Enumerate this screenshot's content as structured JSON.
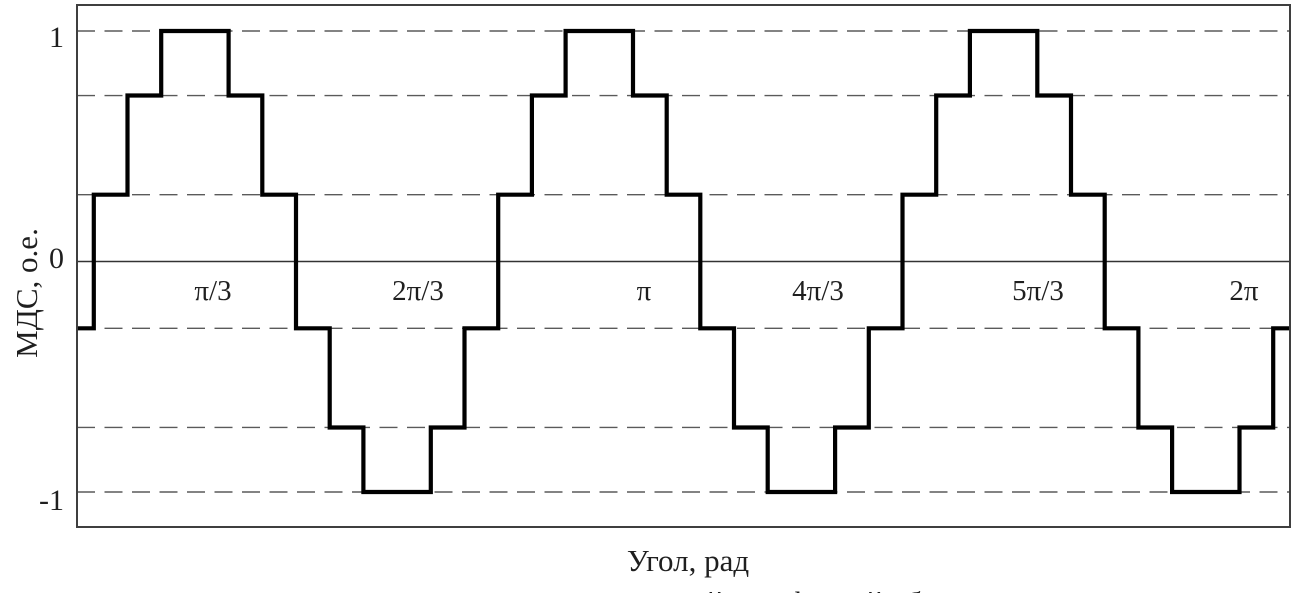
{
  "figure": {
    "caption": "Рис. 6. МДС симметричной трехфазной обмотки"
  },
  "chart_data": {
    "type": "line",
    "subtype": "step-staircase-waveform",
    "title": "",
    "xlabel": "Угол, рад",
    "ylabel": "МДС, о.е.",
    "xlim_rad": [
      0,
      6.2832
    ],
    "ylim": [
      -1.15,
      1.11
    ],
    "grid": "dashed horizontal lines at waveform step levels",
    "legend": "none",
    "x_ticks": [
      {
        "label": "π/3",
        "value_rad": 1.0472
      },
      {
        "label": "2π/3",
        "value_rad": 2.0944
      },
      {
        "label": "π",
        "value_rad": 3.1416
      },
      {
        "label": "4π/3",
        "value_rad": 4.1888
      },
      {
        "label": "5π/3",
        "value_rad": 5.236
      },
      {
        "label": "2π",
        "value_rad": 6.2832
      }
    ],
    "y_ticks": [
      {
        "label": "1",
        "value": 1
      },
      {
        "label": "0",
        "value": 0
      },
      {
        "label": "-1",
        "value": -1
      }
    ],
    "dashed_gridline_values": [
      1,
      0.72,
      0.29,
      -0.29,
      -0.72,
      -1
    ],
    "solid_gridline_values": [
      0
    ],
    "waveform": {
      "description": "Periodic MMF staircase, 3 identical periods over 0..2π; step levels ±0.29, ±0.72, ±1",
      "period_deg": 120,
      "start_level": -0.29,
      "first_transition_deg": 5,
      "block": [
        {
          "level": 0.29,
          "width_deg": 10
        },
        {
          "level": 0.72,
          "width_deg": 10
        },
        {
          "level": 1,
          "width_deg": 20
        },
        {
          "level": 0.72,
          "width_deg": 10
        },
        {
          "level": 0.29,
          "width_deg": 10
        },
        {
          "level": -0.29,
          "width_deg": 10
        },
        {
          "level": -0.72,
          "width_deg": 10
        },
        {
          "level": -1,
          "width_deg": 20
        },
        {
          "level": -0.72,
          "width_deg": 10
        },
        {
          "level": -0.29,
          "width_deg": 10
        }
      ],
      "repeats": 3,
      "end_deg": 360
    },
    "layout": {
      "plot_px": {
        "left": 77,
        "top": 5,
        "right": 1290,
        "bottom": 527
      },
      "y_zero_px": 261.5,
      "px_per_unit": 230.5,
      "x_tick_center_px": [
        213,
        418,
        644,
        818,
        1038,
        1244
      ],
      "x_tick_center_y_px": 291,
      "y_tick_center_y_px": [
        38,
        259,
        501
      ],
      "colors": {
        "waveform": "#000000",
        "grid": "#5a5a5a",
        "zero_line": "#333333",
        "border": "#3f3f3f",
        "text": "#1f1f1f",
        "background": "#ffffff"
      }
    }
  }
}
